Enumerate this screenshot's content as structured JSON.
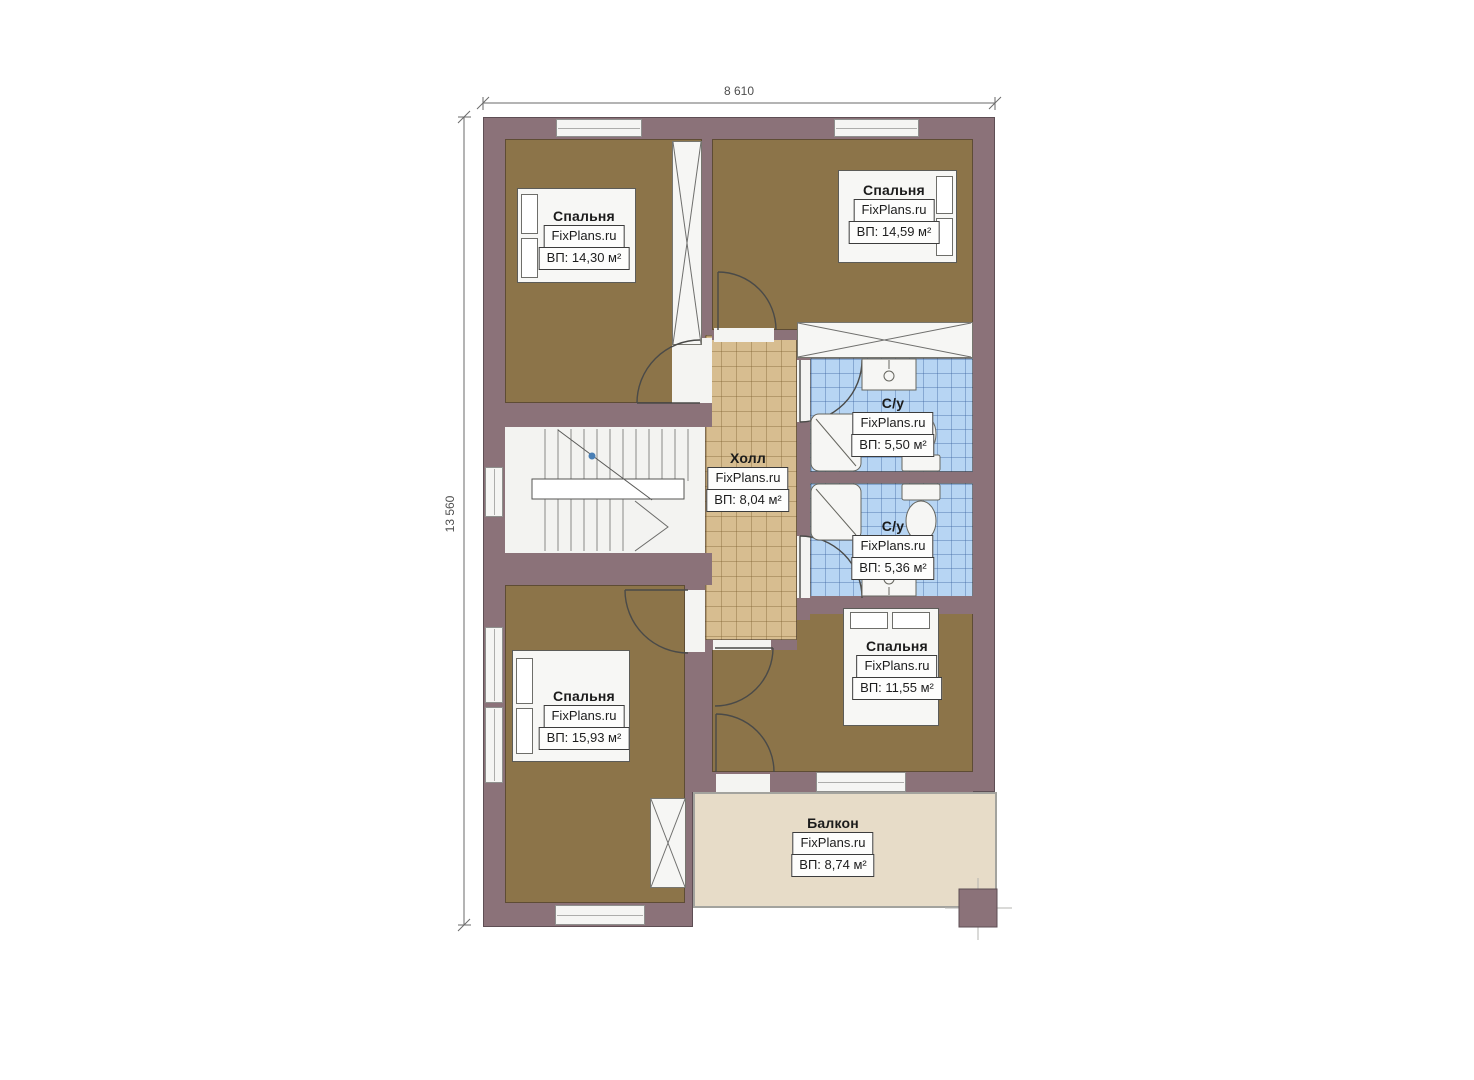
{
  "brand": "FixPlans.ru",
  "dimensions": {
    "top": "8 610",
    "left": "13 560"
  },
  "rooms": {
    "bedroom_tl": {
      "name": "Спальня",
      "brand": "FixPlans.ru",
      "area": "ВП: 14,30 м²"
    },
    "bedroom_tr": {
      "name": "Спальня",
      "brand": "FixPlans.ru",
      "area": "ВП: 14,59 м²"
    },
    "hall": {
      "name": "Холл",
      "brand": "FixPlans.ru",
      "area": "ВП: 8,04 м²"
    },
    "bath_top": {
      "name": "С/у",
      "brand": "FixPlans.ru",
      "area": "ВП: 5,50 м²"
    },
    "bath_bottom": {
      "name": "С/у",
      "brand": "FixPlans.ru",
      "area": "ВП: 5,36 м²"
    },
    "bedroom_br": {
      "name": "Спальня",
      "brand": "FixPlans.ru",
      "area": "ВП: 11,55 м²"
    },
    "bedroom_bl": {
      "name": "Спальня",
      "brand": "FixPlans.ru",
      "area": "ВП: 15,93 м²"
    },
    "balcony": {
      "name": "Балкон",
      "brand": "FixPlans.ru",
      "area": "ВП: 8,74 м²"
    }
  },
  "colors": {
    "wall": "#8b7279",
    "floor_wood": "#8c7449",
    "tile_hall": "#d7bd90",
    "tile_bath": "#b7d5f3",
    "balcony": "#e7dcc8"
  }
}
